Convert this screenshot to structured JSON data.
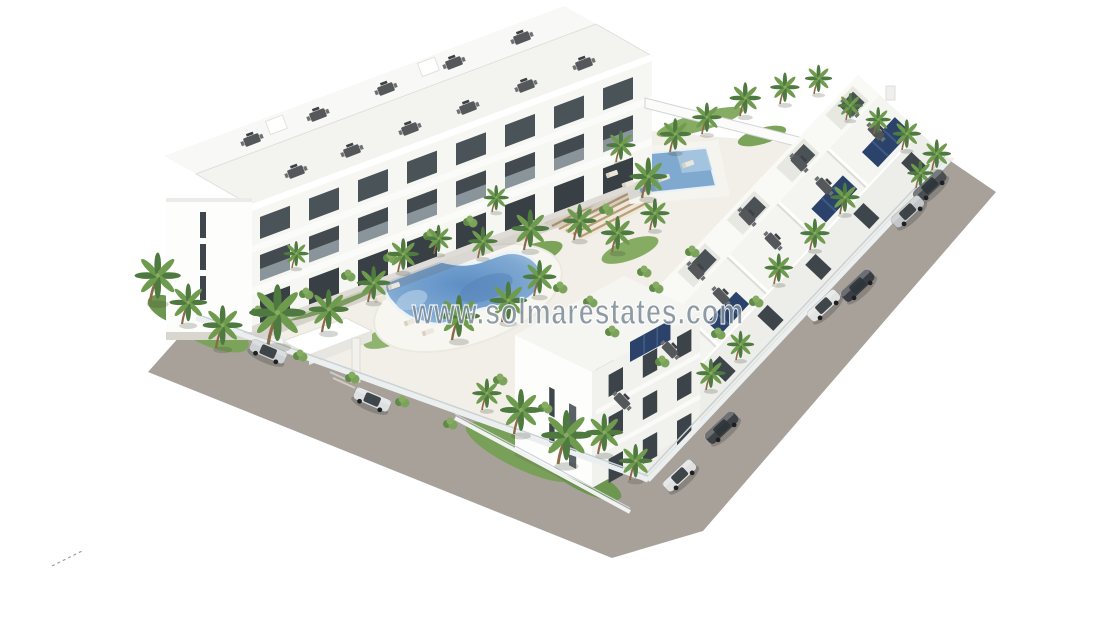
{
  "image": {
    "kind": "3d-architectural-render",
    "subject": "Aerial oblique render of a white three-storey apartment complex with courtyard, kidney pool, lap pool, wooden pergola, palm gardens, perimeter glass fence and surrounding road with parked cars, on a plain white background"
  },
  "watermark": {
    "text": "www.solmarestates.com",
    "color": "#7d8c98",
    "outline": "#ffffff"
  },
  "signature": {
    "present": true,
    "style": "small dashed pencil mark, bottom left"
  },
  "colors": {
    "road": "#a8a19a",
    "ground": "#f2efe9",
    "building": "#f6f6f3",
    "buildingBright": "#fdfdfc",
    "buildingShade": "#ededea",
    "window": "#3e464b",
    "poolDeep": "#5d8ec5",
    "poolMid": "#7fa9d2",
    "poolShallow": "#a9c8e2",
    "grass": "#7ba35a",
    "grassDark": "#5f8a48",
    "palmFrond": "#4e7a3f",
    "palmFrondLight": "#6f9b4f",
    "trunk": "#8a6a49",
    "pergola": "#b99e78",
    "pergolaBase": "#efe8da",
    "solarPanel": "#2b436a",
    "fence": "#c9d2d5"
  },
  "scene": {
    "palms": [
      [
        150,
        302,
        1.1
      ],
      [
        182,
        324,
        0.9
      ],
      [
        216,
        348,
        0.95
      ],
      [
        268,
        345,
        1.35
      ],
      [
        322,
        332,
        0.95
      ],
      [
        368,
        302,
        0.8
      ],
      [
        292,
        268,
        0.6
      ],
      [
        398,
        272,
        0.75
      ],
      [
        434,
        254,
        0.65
      ],
      [
        452,
        340,
        1.0
      ],
      [
        502,
        322,
        0.9
      ],
      [
        534,
        296,
        0.8
      ],
      [
        478,
        258,
        0.7
      ],
      [
        524,
        250,
        0.9
      ],
      [
        574,
        240,
        0.8
      ],
      [
        612,
        252,
        0.8
      ],
      [
        650,
        230,
        0.7
      ],
      [
        492,
        212,
        0.6
      ],
      [
        642,
        198,
        0.9
      ],
      [
        616,
        162,
        0.7
      ],
      [
        670,
        152,
        0.75
      ],
      [
        702,
        134,
        0.7
      ],
      [
        740,
        116,
        0.75
      ],
      [
        780,
        104,
        0.7
      ],
      [
        814,
        94,
        0.65
      ],
      [
        846,
        120,
        0.6
      ],
      [
        874,
        134,
        0.6
      ],
      [
        902,
        150,
        0.68
      ],
      [
        932,
        170,
        0.68
      ],
      [
        916,
        188,
        0.62
      ],
      [
        840,
        214,
        0.7
      ],
      [
        810,
        250,
        0.7
      ],
      [
        774,
        284,
        0.68
      ],
      [
        514,
        434,
        1.0
      ],
      [
        558,
        464,
        1.2
      ],
      [
        598,
        454,
        0.9
      ],
      [
        630,
        480,
        0.8
      ],
      [
        482,
        410,
        0.7
      ],
      [
        706,
        390,
        0.7
      ],
      [
        736,
        360,
        0.65
      ]
    ],
    "bushes": [
      [
        258,
        312
      ],
      [
        306,
        294
      ],
      [
        348,
        276
      ],
      [
        390,
        258
      ],
      [
        300,
        356
      ],
      [
        352,
        378
      ],
      [
        402,
        402
      ],
      [
        450,
        424
      ],
      [
        590,
        302
      ],
      [
        644,
        272
      ],
      [
        692,
        252
      ],
      [
        612,
        332
      ],
      [
        662,
        362
      ],
      [
        718,
        334
      ],
      [
        756,
        302
      ],
      [
        560,
        288
      ],
      [
        606,
        210
      ],
      [
        656,
        288
      ],
      [
        500,
        380
      ],
      [
        545,
        408
      ],
      [
        430,
        236
      ],
      [
        470,
        222
      ]
    ],
    "loungers": [
      [
        394,
        286,
        -20
      ],
      [
        380,
        299,
        -20
      ],
      [
        410,
        322,
        -20
      ],
      [
        428,
        332,
        -20
      ],
      [
        612,
        174,
        -20
      ],
      [
        628,
        184,
        -20
      ],
      [
        646,
        194,
        -20
      ],
      [
        664,
        178,
        -20
      ],
      [
        688,
        164,
        -20
      ]
    ],
    "roof_furniture": [
      [
        296,
        172,
        -21
      ],
      [
        352,
        151,
        -21
      ],
      [
        410,
        129,
        -21
      ],
      [
        468,
        108,
        -21
      ],
      [
        526,
        86,
        -21
      ],
      [
        584,
        64,
        -21
      ],
      [
        252,
        140,
        -21
      ],
      [
        318,
        115,
        -21
      ],
      [
        386,
        89,
        -21
      ],
      [
        454,
        63,
        -21
      ],
      [
        522,
        38,
        -21
      ],
      [
        876,
        132,
        46
      ],
      [
        824,
        186,
        46
      ],
      [
        773,
        241,
        46
      ],
      [
        721,
        296,
        46
      ],
      [
        670,
        350,
        46
      ],
      [
        622,
        401,
        46
      ],
      [
        850,
        108,
        46
      ],
      [
        799,
        163,
        46
      ],
      [
        747,
        217,
        46
      ],
      [
        696,
        271,
        46
      ]
    ],
    "cars": [
      {
        "x": 268,
        "y": 352,
        "rot": 23,
        "color": "#cfd2d4",
        "name": "silver-suv"
      },
      {
        "x": 372,
        "y": 400,
        "rot": 23,
        "color": "#dddfe0",
        "name": "white-sedan"
      },
      {
        "x": 930,
        "y": 186,
        "rot": -43,
        "color": "#4a4e52",
        "name": "dark-hatchback"
      },
      {
        "x": 908,
        "y": 212,
        "rot": -43,
        "color": "#c3c6c8",
        "name": "silver-sedan"
      },
      {
        "x": 858,
        "y": 286,
        "rot": -43,
        "color": "#3a3e44",
        "name": "dark-sedan"
      },
      {
        "x": 824,
        "y": 306,
        "rot": -43,
        "color": "#e2e3e3",
        "name": "white-sedan"
      },
      {
        "x": 722,
        "y": 428,
        "rot": -43,
        "color": "#3f4347",
        "name": "dark-suv"
      },
      {
        "x": 680,
        "y": 476,
        "rot": -43,
        "color": "#dfe0df",
        "name": "white-hatchback"
      }
    ]
  }
}
